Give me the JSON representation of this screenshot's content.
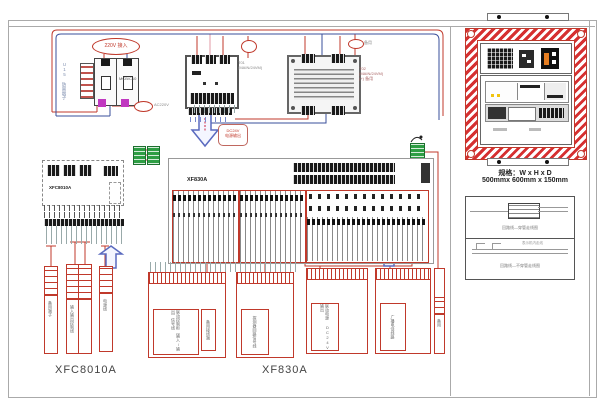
{
  "power": {
    "input_label": "220V 接入",
    "surge_label": "U15 防雷端子",
    "breaker_label": "MCB/C10",
    "spare_tag": "AC220V",
    "t01_line1": "T01",
    "t01_line2": "(MAIN/24VM)",
    "t02_line1": "T02",
    "t02_line2": "(MAIN/24VM)",
    "t02_line3": "(+) 备用",
    "tap_tag": "备用"
  },
  "callout": {
    "line1": "DC24V",
    "line2": "电源输出"
  },
  "boards": {
    "left_label": "XFC8010A",
    "center_label": "XF830A"
  },
  "cabinet": {
    "spec_line1": "规格：W x H x D",
    "spec_line2": "500mmx 600mm x 150mm"
  },
  "legend": {
    "caption1": "回路线—穿管走线图",
    "caption2": "回路线—不穿管走线图",
    "note": "表示机内走线"
  },
  "tables": {
    "a1": "备用端子",
    "a2": "输入输出控制线",
    "a3": "电源线",
    "t1": "联动控制柜（输入/输出）信号线",
    "t1b": "备用接线端",
    "t2": "探测器回路信号线",
    "t3": "联动电源 DC24V 输出",
    "t4": "广播电话线路",
    "d": "备用"
  },
  "footer": {
    "left_model": "XFC8010A",
    "center_model": "XF830A"
  },
  "colors": {
    "wire_red": "#c0392b",
    "wire_blue": "#3a4f9b",
    "green": "#2e9e44"
  }
}
